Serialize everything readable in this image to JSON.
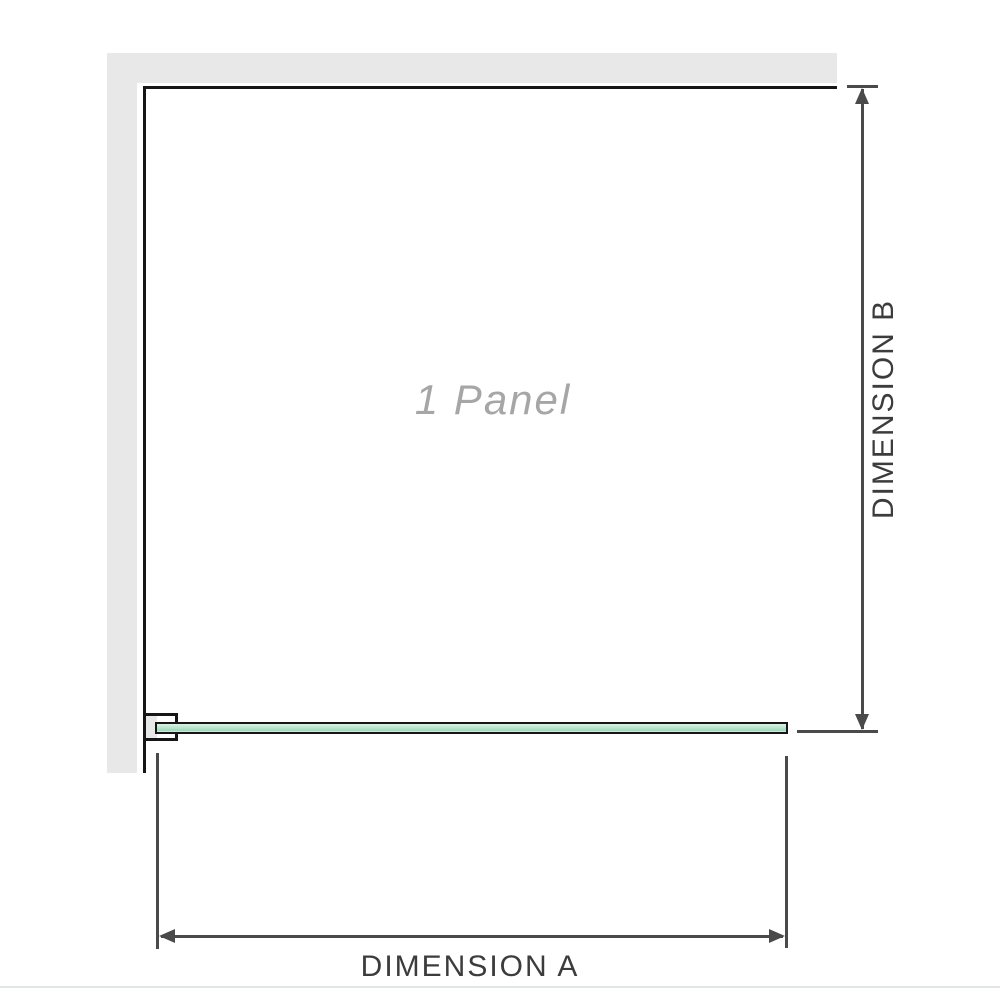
{
  "diagram": {
    "panel_label": "1 Panel",
    "dimension_a_label": "DIMENSION A",
    "dimension_b_label": "DIMENSION B"
  },
  "colors": {
    "wall": "#e8e8e8",
    "outline": "#161616",
    "dimension": "#4a4a4a",
    "label_text": "#3c3c3c",
    "panel_text": "#a6a6a6",
    "glass_light": "#ddf2e6",
    "glass_mid": "#b4e2ca",
    "glass_dark": "#9fd7ba",
    "baseline": "#e2e6e2"
  }
}
